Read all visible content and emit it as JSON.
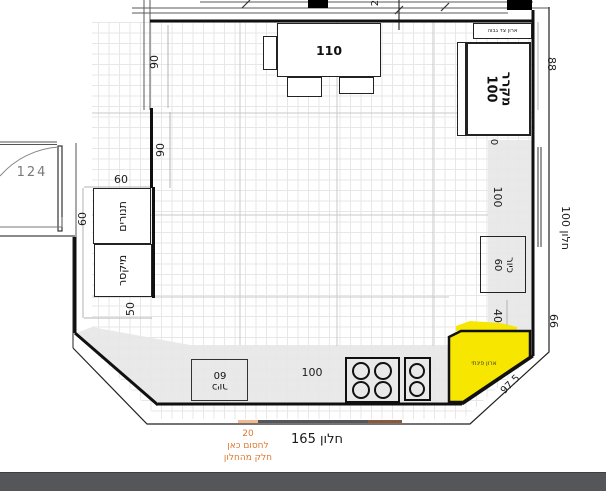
{
  "colors": {
    "highlight_yellow": "#f7e600",
    "note_orange": "#e0782f",
    "counter_gray": "#e9e9e9",
    "footer_bar": "#55565a",
    "window_peach": "#f4b98f",
    "window_dark": "#56575a",
    "window_brown": "#8a5a3e"
  },
  "fixtures": {
    "table": {
      "size": "110"
    },
    "ovens": {
      "label": "תנורים"
    },
    "mixer": {
      "label": "מיקסר"
    },
    "fridge": {
      "label": "מקרר",
      "size": "100"
    },
    "tall_side_cabinet": {
      "label": "ארון צד גבוה"
    },
    "sink_wall": {
      "label": "כיור",
      "size": "60"
    },
    "sink_island": {
      "label": "כיור",
      "size": "60"
    },
    "corner_cabinet": {
      "label": "ארון פינתי"
    }
  },
  "windows": {
    "right": "חלון 100",
    "bottom": "חלון 165"
  },
  "dimensions": {
    "door": "124",
    "upper_left_a": "90",
    "upper_left_b": "90",
    "ovens_top": "60",
    "ovens_side": "60",
    "below_mixer": "50",
    "fridge_side": "88",
    "zero": "0",
    "right_counter": "100",
    "corner_gap": "40",
    "wall_segment": "66",
    "diagonal": "97.5",
    "bottom_counter": "100",
    "top_partial": "2"
  },
  "note": {
    "value": "20",
    "line1": "לחסום כאן",
    "line2": "חלק מהחלון"
  }
}
